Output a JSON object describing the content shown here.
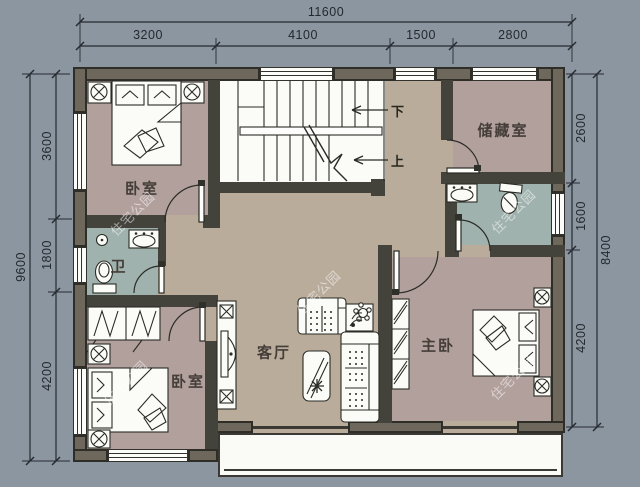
{
  "dimensions": {
    "top": {
      "total": "11600",
      "segments": [
        "3200",
        "4100",
        "1500",
        "2800"
      ]
    },
    "left": {
      "total": "9600",
      "segments": [
        "3600",
        "1800",
        "4200"
      ]
    },
    "right": {
      "total": "8400",
      "segments": [
        "2600",
        "1600",
        "4200"
      ]
    }
  },
  "rooms": {
    "bedroom_top": "卧室",
    "storage": "储藏室",
    "bath_left": "卫",
    "living": "客厅",
    "master": "主卧",
    "bedroom_bottom": "卧室"
  },
  "stairs": {
    "down": "下",
    "up": "上"
  },
  "watermark": "住宅公园",
  "colors": {
    "background": "#8c96a1",
    "floor_room": "#b2a09d",
    "floor_hall": "#b9ac9b",
    "floor_bath": "#a0b2ad",
    "floor_white": "#fafaf6",
    "wall_exterior": "#6e685c",
    "wall_interior": "#43423b",
    "line": "#2b2b26"
  }
}
